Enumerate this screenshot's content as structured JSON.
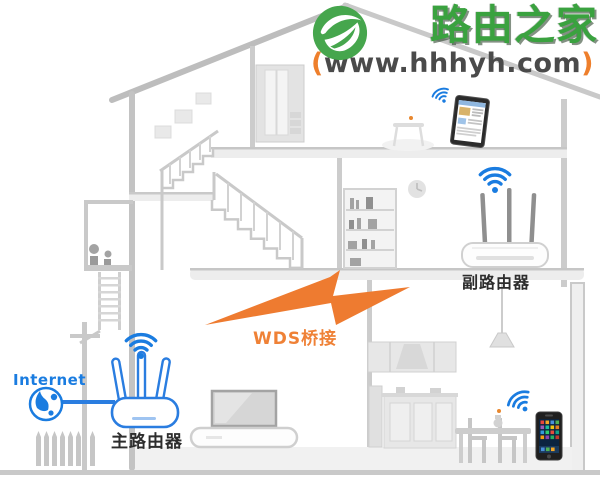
{
  "page": {
    "width": 600,
    "height": 481,
    "background": "#ffffff",
    "kind": "WDS bridging network diagram inside a house cross-section"
  },
  "logo": {
    "brand": "路由之家",
    "paren_open": "(",
    "url": "www.hhhyh.com",
    "paren_close": ")",
    "brand_color": "#3aa23f",
    "accent_orange": "#ee7f2c",
    "url_color": "#4a4a4a",
    "icon": "leaf-e-logo-icon",
    "icon_color": "#46a64d"
  },
  "diagram": {
    "internet_label": "Internet",
    "main_router_label": "主路由器",
    "secondary_router_label": "副路由器",
    "bridge_label": "WDS桥接",
    "colors": {
      "wifi_blue": "#1a7ce0",
      "bridge_orange": "#ee7b30",
      "structure_gray": "#c9c9c9"
    },
    "icons": {
      "wifi": "wifi-signal-icon",
      "globe": "internet-globe-icon",
      "bolt": "lightning-bolt-icon",
      "clock": "wall-clock-icon",
      "lamp": "pendant-lamp-icon"
    },
    "devices": [
      "main-router",
      "secondary-router",
      "tablet",
      "smartphone",
      "tv"
    ]
  }
}
